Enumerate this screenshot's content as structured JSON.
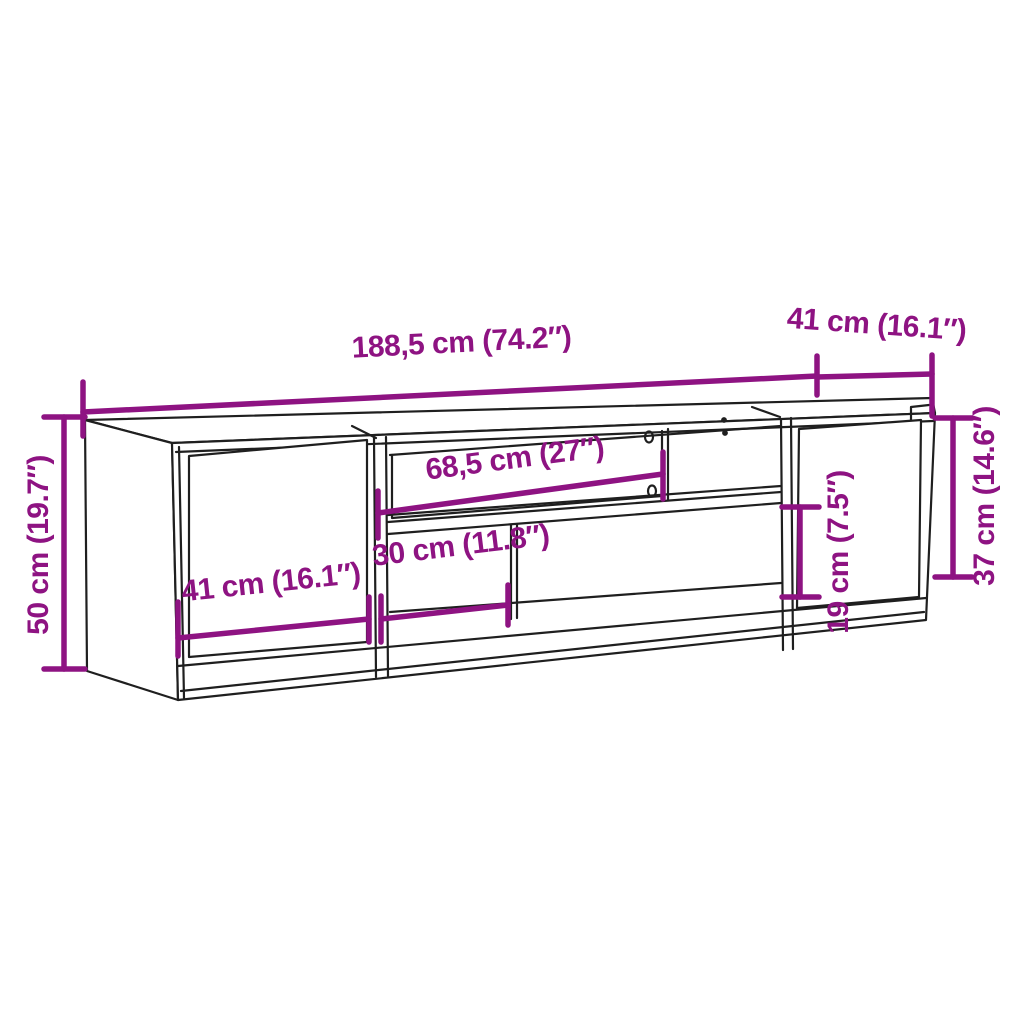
{
  "diagram": {
    "colors": {
      "accent": "#8E1382",
      "line": "#1F1F1F",
      "background": "#FFFFFF"
    },
    "dimensions": {
      "total_width": "188,5 cm (74.2″)",
      "depth": "41 cm (16.1″)",
      "total_height": "50 cm (19.7″)",
      "inner_shelf_width": "68,5 cm (27″)",
      "door_width": "41 cm (16.1″)",
      "open_compartment_width": "30 cm (11.8″)",
      "open_compartment_height": "19 cm (7.5″)",
      "right_section_height": "37 cm (14.6″)"
    }
  }
}
